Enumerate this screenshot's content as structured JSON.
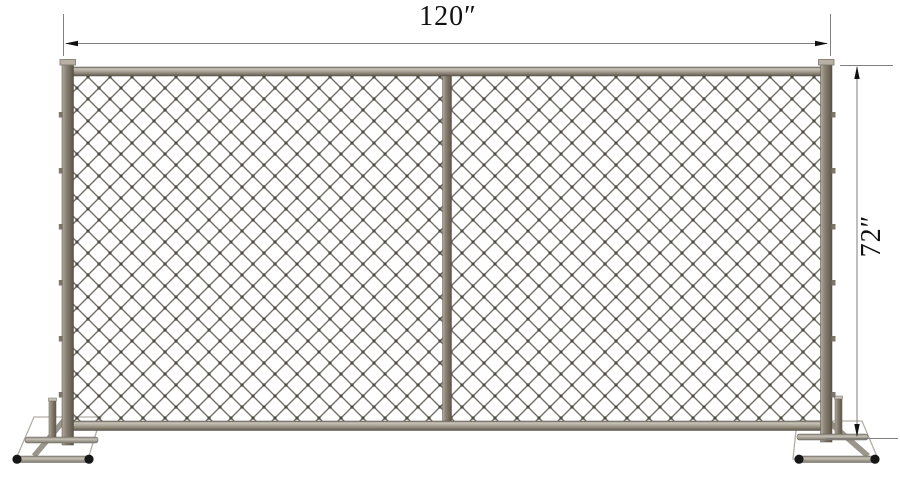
{
  "diagram": {
    "subject": "Temporary chain-link fence panel with two tube stands, front elevation with dimensions",
    "dimensions": {
      "width": "120″",
      "height": "72″"
    },
    "colors": {
      "background": "#ffffff",
      "frame": "#857e71",
      "rail_highlight": "#c6c1b7",
      "mesh_wire": "#736f68",
      "mesh_knot": "#4c4942",
      "foot_tube": "#aba599",
      "end_cap": "#161616",
      "dimension_line": "#7f7f7f",
      "dimension_text": "#111111"
    }
  }
}
